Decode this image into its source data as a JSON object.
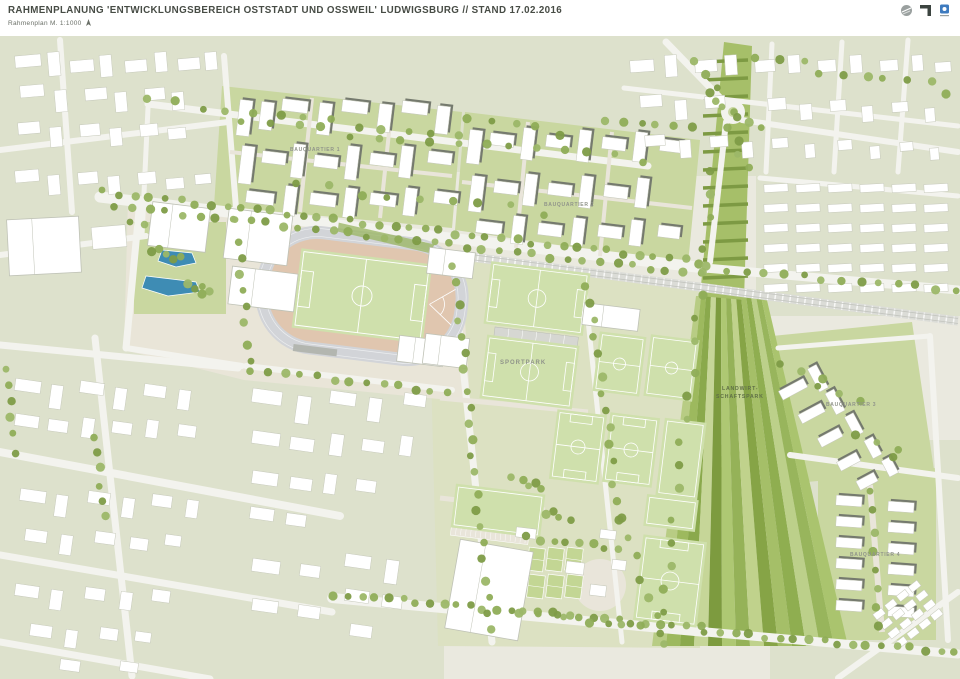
{
  "header": {
    "title": "RAHMENPLANUNG 'ENTWICKLUNGSBEREICH OSTSTADT UND OSSWEIL' LUDWIGSBURG // STAND 17.02.2016",
    "subtitle": "Rahmenplan M. 1:1000",
    "north_arrow_icon": "north-arrow",
    "logos": [
      "globe-logo",
      "corner-bracket-logo",
      "blue-square-logo"
    ]
  },
  "map_labels": {
    "bauquartier1": "BAUQUARTIER 1",
    "bauquartier2": "BAUQUARTIER 2",
    "bauquartier3": "BAUQUARTIER 3",
    "bauquartier4": "BAUQUARTIER 4",
    "sportpark": "SPORTPARK",
    "landwirtschaftspark_line1": "LANDWIRT-",
    "landwirtschaftspark_line2": "SCHAFTSPARK"
  },
  "palette": {
    "paper": "#ffffff",
    "base": "#eae9df",
    "sage": "#dde1cc",
    "road": "#f3f3ee",
    "pathBeige": "#e9e5da",
    "quarterGreen": "#c9d7a0",
    "sportLawn": "#dce1c2",
    "stadiumEnv": "#e9e5d8",
    "fieldGreen": "#cfe0ac",
    "fieldLine": "#ffffff",
    "courtGreen": "#c3d694",
    "trackTan": "#e0c6af",
    "trackRing": "#d2d4d8",
    "railGray": "#dbdcd7",
    "bleacher": "#d6d7d2",
    "treeA": "#8fad57",
    "treeB": "#7e9c47",
    "treeC": "#9cb768",
    "roofDark": "#757a6e",
    "buildingWhite": "#ffffff",
    "buildingStroke": "#c6c9bb",
    "bigStroke": "#bfc2b6",
    "poolBlue": "#3e8cb4",
    "allotment": "#a6bf69",
    "allotmentRow": "#7d9a43",
    "labelGray": "#90948a",
    "labelGreen": "#5f6f46",
    "titleColor": "#474c45",
    "agriStripes": [
      "#b8cc84",
      "#9db95e",
      "#8aa94c",
      "#c6d698",
      "#7d9b3f",
      "#aec873",
      "#95b258",
      "#c0d28c",
      "#86a446",
      "#a5bf68",
      "#8fae50",
      "#bcd08a",
      "#98b55c",
      "#aac46e"
    ]
  }
}
